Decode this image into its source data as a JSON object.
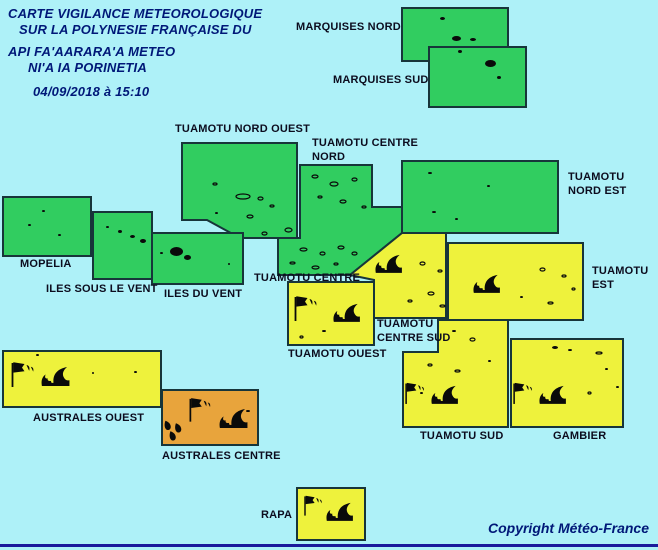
{
  "title": {
    "line1": "CARTE VIGILANCE METEOROLOGIQUE",
    "line2": "SUR LA POLYNESIE FRANÇAISE DU",
    "line3": "API FA'AARARA'A METEO",
    "line4": "NI'A IA PORINETIA",
    "datetime": "04/09/2018 à 15:10"
  },
  "copyright": "Copyright Météo-France",
  "colors": {
    "background": "#AEF1F8",
    "green": "#31CD60",
    "yellow": "#EEF23C",
    "orange": "#E8A43C",
    "border": "#17353A",
    "island": "#0A0A0A",
    "title_navy": "#001878",
    "label_dark": "#0C0C1E",
    "bottom_line": "#1A1A9C"
  },
  "map": {
    "zones": [
      {
        "id": "marquises-nord",
        "label": "MARQUISES NORD",
        "level": "green",
        "hazards": [],
        "points": [
          [
            402,
            8
          ],
          [
            508,
            8
          ],
          [
            508,
            61
          ],
          [
            402,
            61
          ]
        ]
      },
      {
        "id": "marquises-sud",
        "label": "MARQUISES SUD",
        "level": "green",
        "hazards": [],
        "points": [
          [
            429,
            47
          ],
          [
            526,
            47
          ],
          [
            526,
            107
          ],
          [
            429,
            107
          ]
        ]
      },
      {
        "id": "tuamotu-nord-ouest",
        "label": "TUAMOTU NORD OUEST",
        "level": "green",
        "hazards": [],
        "points": [
          [
            182,
            143
          ],
          [
            297,
            143
          ],
          [
            297,
            238
          ],
          [
            240,
            238
          ],
          [
            207,
            220
          ],
          [
            182,
            220
          ]
        ]
      },
      {
        "id": "tuamotu-centre-nord",
        "label": "TUAMOTU CENTRE NORD",
        "level": "green",
        "hazards": [],
        "points": [
          [
            300,
            165
          ],
          [
            372,
            165
          ],
          [
            372,
            207
          ],
          [
            402,
            207
          ],
          [
            402,
            233
          ],
          [
            350,
            275
          ],
          [
            278,
            275
          ],
          [
            278,
            238
          ],
          [
            300,
            238
          ]
        ]
      },
      {
        "id": "tuamotu-nord-est",
        "label": "TUAMOTU NORD EST",
        "level": "green",
        "hazards": [],
        "points": [
          [
            402,
            161
          ],
          [
            558,
            161
          ],
          [
            558,
            233
          ],
          [
            402,
            233
          ]
        ]
      },
      {
        "id": "mopelia",
        "label": "MOPELIA",
        "level": "green",
        "hazards": [],
        "points": [
          [
            3,
            197
          ],
          [
            91,
            197
          ],
          [
            91,
            256
          ],
          [
            3,
            256
          ]
        ]
      },
      {
        "id": "iles-sous-le-vent",
        "label": "ILES SOUS LE VENT",
        "level": "green",
        "hazards": [],
        "points": [
          [
            93,
            212
          ],
          [
            152,
            212
          ],
          [
            152,
            279
          ],
          [
            93,
            279
          ]
        ]
      },
      {
        "id": "iles-du-vent",
        "label": "ILES DU VENT",
        "level": "green",
        "hazards": [],
        "points": [
          [
            152,
            233
          ],
          [
            243,
            233
          ],
          [
            243,
            284
          ],
          [
            152,
            284
          ]
        ]
      },
      {
        "id": "tuamotu-centre",
        "label": "TUAMOTU CENTRE",
        "level": "yellow",
        "hazards": [
          "high-waves"
        ],
        "points": [
          [
            350,
            275
          ],
          [
            402,
            233
          ],
          [
            446,
            233
          ],
          [
            446,
            318
          ],
          [
            374,
            318
          ],
          [
            374,
            280
          ]
        ]
      },
      {
        "id": "tuamotu-est",
        "label": "TUAMOTU EST",
        "level": "yellow",
        "hazards": [
          "high-waves"
        ],
        "points": [
          [
            448,
            243
          ],
          [
            583,
            243
          ],
          [
            583,
            320
          ],
          [
            448,
            320
          ]
        ]
      },
      {
        "id": "tuamotu-ouest",
        "label": "TUAMOTU OUEST",
        "level": "yellow",
        "hazards": [
          "strong-wind",
          "high-waves"
        ],
        "points": [
          [
            288,
            282
          ],
          [
            374,
            282
          ],
          [
            374,
            345
          ],
          [
            288,
            345
          ]
        ]
      },
      {
        "id": "tuamotu-centre-sud-et-sud",
        "label": "TUAMOTU CENTRE SUD / TUAMOTU SUD",
        "level": "yellow",
        "hazards": [
          "strong-wind",
          "high-waves"
        ],
        "points": [
          [
            438,
            320
          ],
          [
            508,
            320
          ],
          [
            508,
            427
          ],
          [
            403,
            427
          ],
          [
            403,
            352
          ],
          [
            438,
            352
          ]
        ]
      },
      {
        "id": "gambier",
        "label": "GAMBIER",
        "level": "yellow",
        "hazards": [
          "strong-wind",
          "high-waves"
        ],
        "points": [
          [
            511,
            339
          ],
          [
            623,
            339
          ],
          [
            623,
            427
          ],
          [
            511,
            427
          ]
        ]
      },
      {
        "id": "australes-ouest",
        "label": "AUSTRALES OUEST",
        "level": "yellow",
        "hazards": [
          "strong-wind",
          "high-waves"
        ],
        "points": [
          [
            3,
            351
          ],
          [
            161,
            351
          ],
          [
            161,
            407
          ],
          [
            3,
            407
          ]
        ]
      },
      {
        "id": "australes-centre",
        "label": "AUSTRALES CENTRE",
        "level": "orange",
        "hazards": [
          "strong-wind",
          "high-waves",
          "heavy-rain"
        ],
        "points": [
          [
            162,
            390
          ],
          [
            258,
            390
          ],
          [
            258,
            445
          ],
          [
            162,
            445
          ]
        ]
      },
      {
        "id": "rapa",
        "label": "RAPA",
        "level": "yellow",
        "hazards": [
          "strong-wind",
          "high-waves"
        ],
        "points": [
          [
            297,
            488
          ],
          [
            365,
            488
          ],
          [
            365,
            540
          ],
          [
            297,
            540
          ]
        ]
      }
    ],
    "labels": [
      {
        "id": "marquises-nord",
        "text": "MARQUISES NORD",
        "x": 296,
        "y": 21
      },
      {
        "id": "marquises-sud",
        "text": "MARQUISES SUD",
        "x": 333,
        "y": 74
      },
      {
        "id": "tuamotu-nord-ouest",
        "text": "TUAMOTU NORD OUEST",
        "x": 175,
        "y": 123
      },
      {
        "id": "tuamotu-centre-nord",
        "text": "TUAMOTU CENTRE\nNORD",
        "x": 312,
        "y": 137
      },
      {
        "id": "tuamotu-nord-est",
        "text": "TUAMOTU\nNORD EST",
        "x": 568,
        "y": 171
      },
      {
        "id": "mopelia",
        "text": "MOPELIA",
        "x": 20,
        "y": 258
      },
      {
        "id": "iles-sous-le-vent",
        "text": "ILES SOUS LE VENT",
        "x": 46,
        "y": 283
      },
      {
        "id": "iles-du-vent",
        "text": "ILES DU VENT",
        "x": 164,
        "y": 288
      },
      {
        "id": "tuamotu-centre",
        "text": "TUAMOTU CENTRE",
        "x": 254,
        "y": 272
      },
      {
        "id": "tuamotu-est",
        "text": "TUAMOTU\nEST",
        "x": 592,
        "y": 265
      },
      {
        "id": "tuamotu-centre-sud",
        "text": "TUAMOTU\nCENTRE SUD",
        "x": 377,
        "y": 318
      },
      {
        "id": "tuamotu-ouest",
        "text": "TUAMOTU OUEST",
        "x": 288,
        "y": 348
      },
      {
        "id": "australes-ouest",
        "text": "AUSTRALES OUEST",
        "x": 33,
        "y": 412
      },
      {
        "id": "australes-centre",
        "text": "AUSTRALES CENTRE",
        "x": 162,
        "y": 450
      },
      {
        "id": "tuamotu-sud",
        "text": "TUAMOTU SUD",
        "x": 420,
        "y": 430
      },
      {
        "id": "gambier",
        "text": "GAMBIER",
        "x": 553,
        "y": 430
      },
      {
        "id": "rapa",
        "text": "RAPA",
        "x": 261,
        "y": 509
      }
    ],
    "icons": [
      {
        "type": "wave",
        "x": 374,
        "y": 254,
        "s": 0.9
      },
      {
        "type": "wave",
        "x": 472,
        "y": 274,
        "s": 0.9
      },
      {
        "type": "wind-flag",
        "x": 293,
        "y": 294,
        "s": 1.0
      },
      {
        "type": "wave",
        "x": 332,
        "y": 303,
        "s": 0.9
      },
      {
        "type": "wind-flag",
        "x": 10,
        "y": 360,
        "s": 1.0
      },
      {
        "type": "wave",
        "x": 40,
        "y": 366,
        "s": 0.95
      },
      {
        "type": "wind-flag",
        "x": 188,
        "y": 396,
        "s": 0.95
      },
      {
        "type": "wave",
        "x": 218,
        "y": 408,
        "s": 0.95
      },
      {
        "type": "heavy-rain",
        "x": 163,
        "y": 420,
        "s": 1.0
      },
      {
        "type": "wind-flag",
        "x": 404,
        "y": 381,
        "s": 0.85
      },
      {
        "type": "wave",
        "x": 430,
        "y": 385,
        "s": 0.9
      },
      {
        "type": "wind-flag",
        "x": 512,
        "y": 381,
        "s": 0.85
      },
      {
        "type": "wave",
        "x": 538,
        "y": 385,
        "s": 0.9
      },
      {
        "type": "wind-flag",
        "x": 303,
        "y": 494,
        "s": 0.8
      },
      {
        "type": "wave",
        "x": 325,
        "y": 502,
        "s": 0.9
      }
    ],
    "islands": [
      [
        440,
        17,
        5,
        3,
        "fill"
      ],
      [
        452,
        36,
        9,
        5,
        "fill"
      ],
      [
        470,
        38,
        6,
        3,
        "fill"
      ],
      [
        458,
        50,
        4,
        3,
        "fill"
      ],
      [
        485,
        60,
        11,
        7,
        "fill"
      ],
      [
        497,
        76,
        4,
        3,
        "fill"
      ],
      [
        213,
        183,
        4,
        2,
        "ring"
      ],
      [
        236,
        194,
        14,
        5,
        "ring"
      ],
      [
        258,
        197,
        5,
        3,
        "ring"
      ],
      [
        215,
        212,
        3,
        2,
        "fill"
      ],
      [
        247,
        215,
        6,
        3,
        "ring"
      ],
      [
        270,
        205,
        4,
        2,
        "ring"
      ],
      [
        285,
        228,
        7,
        4,
        "ring"
      ],
      [
        262,
        232,
        5,
        3,
        "ring"
      ],
      [
        312,
        175,
        6,
        3,
        "ring"
      ],
      [
        330,
        182,
        8,
        4,
        "ring"
      ],
      [
        352,
        178,
        5,
        3,
        "ring"
      ],
      [
        318,
        196,
        4,
        2,
        "ring"
      ],
      [
        340,
        200,
        6,
        3,
        "ring"
      ],
      [
        362,
        206,
        4,
        2,
        "ring"
      ],
      [
        300,
        248,
        7,
        3,
        "ring"
      ],
      [
        320,
        252,
        5,
        3,
        "ring"
      ],
      [
        338,
        246,
        6,
        3,
        "ring"
      ],
      [
        290,
        262,
        5,
        2,
        "ring"
      ],
      [
        312,
        266,
        7,
        3,
        "ring"
      ],
      [
        334,
        263,
        4,
        2,
        "ring"
      ],
      [
        352,
        252,
        5,
        3,
        "ring"
      ],
      [
        428,
        172,
        4,
        2,
        "fill"
      ],
      [
        487,
        185,
        3,
        2,
        "fill"
      ],
      [
        432,
        211,
        4,
        2,
        "fill"
      ],
      [
        455,
        218,
        3,
        2,
        "fill"
      ],
      [
        42,
        210,
        3,
        2,
        "fill"
      ],
      [
        28,
        224,
        3,
        2,
        "fill"
      ],
      [
        58,
        234,
        3,
        2,
        "fill"
      ],
      [
        106,
        226,
        3,
        2,
        "fill"
      ],
      [
        118,
        230,
        4,
        3,
        "fill"
      ],
      [
        130,
        235,
        5,
        3,
        "fill"
      ],
      [
        140,
        239,
        6,
        4,
        "fill"
      ],
      [
        170,
        247,
        13,
        9,
        "fill"
      ],
      [
        184,
        255,
        7,
        5,
        "fill"
      ],
      [
        160,
        252,
        3,
        2,
        "fill"
      ],
      [
        228,
        263,
        2,
        2,
        "fill"
      ],
      [
        420,
        262,
        5,
        3,
        "ring"
      ],
      [
        438,
        270,
        4,
        2,
        "ring"
      ],
      [
        428,
        292,
        6,
        3,
        "ring"
      ],
      [
        408,
        300,
        4,
        2,
        "ring"
      ],
      [
        440,
        305,
        5,
        2,
        "ring"
      ],
      [
        540,
        268,
        5,
        3,
        "ring"
      ],
      [
        562,
        275,
        4,
        2,
        "ring"
      ],
      [
        520,
        296,
        3,
        2,
        "fill"
      ],
      [
        548,
        302,
        5,
        2,
        "ring"
      ],
      [
        572,
        288,
        3,
        2,
        "ring"
      ],
      [
        322,
        330,
        4,
        2,
        "fill"
      ],
      [
        352,
        318,
        3,
        2,
        "fill"
      ],
      [
        300,
        336,
        3,
        2,
        "ring"
      ],
      [
        452,
        330,
        4,
        2,
        "fill"
      ],
      [
        470,
        338,
        5,
        3,
        "ring"
      ],
      [
        428,
        364,
        4,
        2,
        "ring"
      ],
      [
        455,
        370,
        5,
        2,
        "ring"
      ],
      [
        488,
        360,
        3,
        2,
        "fill"
      ],
      [
        420,
        392,
        3,
        2,
        "fill"
      ],
      [
        552,
        346,
        6,
        3,
        "fill"
      ],
      [
        568,
        349,
        4,
        2,
        "fill"
      ],
      [
        596,
        352,
        6,
        2,
        "ring"
      ],
      [
        605,
        368,
        3,
        2,
        "fill"
      ],
      [
        588,
        392,
        3,
        2,
        "ring"
      ],
      [
        616,
        386,
        3,
        2,
        "fill"
      ],
      [
        36,
        354,
        3,
        2,
        "fill"
      ],
      [
        92,
        372,
        2,
        2,
        "fill"
      ],
      [
        134,
        371,
        3,
        2,
        "fill"
      ],
      [
        246,
        410,
        4,
        2,
        "fill"
      ]
    ]
  }
}
